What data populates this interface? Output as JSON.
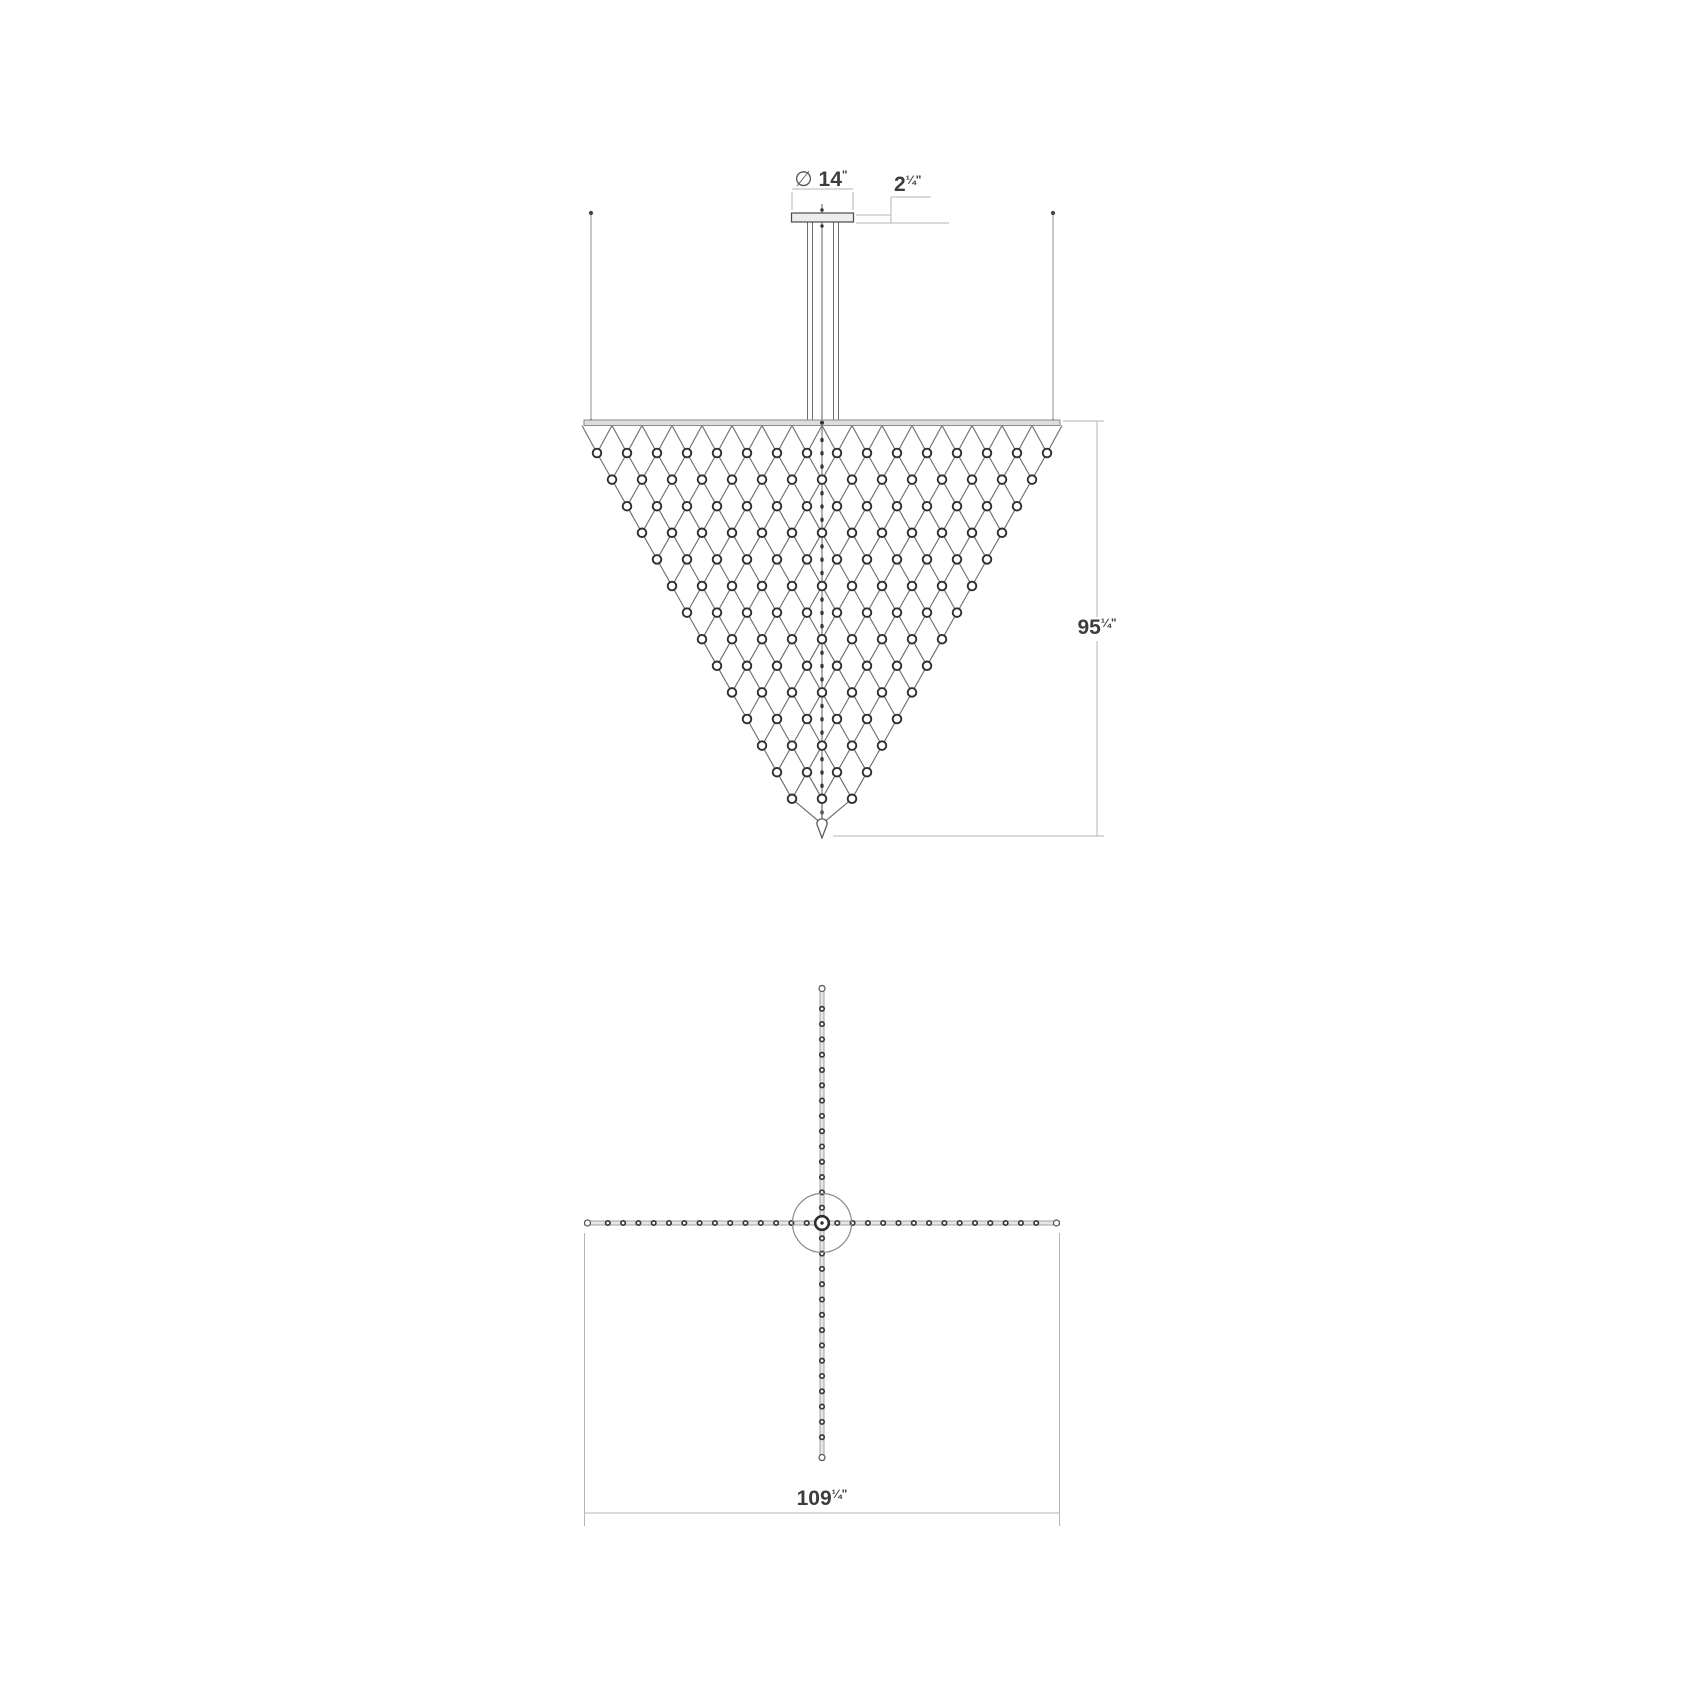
{
  "drawing": {
    "kind": "technical dimension drawing",
    "subject": "inverted pyramid LED net chandelier, elevation and plan views"
  },
  "labels": {
    "canopy_diameter": {
      "prefix": "∅ ",
      "whole": "14",
      "frac": "",
      "unit": "\""
    },
    "canopy_height": {
      "prefix": "",
      "whole": "2",
      "frac": "¼",
      "unit": "\""
    },
    "fixture_height": {
      "prefix": "",
      "whole": "95",
      "frac": "¼",
      "unit": "\""
    },
    "overall_width": {
      "prefix": "",
      "whole": "109",
      "frac": "¼",
      "unit": "\""
    }
  },
  "colors": {
    "background": "#ffffff",
    "net_line": "#6f6f6f",
    "node_stroke": "#2e2e2e",
    "node_fill": "#ffffff",
    "bar_fill": "#dddddd",
    "bar_stroke": "#8a8a8a",
    "plate_fill": "#ededed",
    "plate_stroke": "#4a4a4a",
    "wire": "#9a9a9a",
    "dim_line": "#b5b5b5",
    "text": "#3d3d3d",
    "bead": "#383838",
    "arm_fill": "#e6e6e6",
    "arm_stroke": "#9a9a9a"
  },
  "geometry": {
    "canvas": {
      "w": 1700,
      "h": 1700
    },
    "elevation": {
      "cx": 822,
      "plate": {
        "x": 791.5,
        "y": 213,
        "w": 62,
        "h": 9
      },
      "dim14": {
        "line_y": 189,
        "x1": 792,
        "x2": 853,
        "ext_y1": 192,
        "ext_y2": 210,
        "label_x": 821,
        "label_y": 186
      },
      "dim214": {
        "extA_y": 215,
        "extB_y": 223,
        "ext_x1": 856,
        "extA_x2": 891,
        "extB_x2": 949,
        "vx": 891,
        "v_y1": 197,
        "v_y2": 223,
        "h_y": 197,
        "h_x2": 931,
        "label_x": 894,
        "label_y": 191
      },
      "wires": {
        "lx": 591,
        "rx": 1053,
        "y1": 213,
        "y2": 420
      },
      "rods": {
        "xs": [
          807.5,
          833.5
        ],
        "w": 5,
        "y1": 222,
        "y2": 420
      },
      "stem": {
        "x": 822,
        "y1": 204,
        "y2": 824,
        "dot1_y": 210,
        "dot2_y": 226
      },
      "bar": {
        "x1": 584,
        "x2": 1060,
        "y": 420,
        "h": 5.5
      },
      "net": {
        "rows": 14,
        "y0": 453,
        "row_dy": 26.6,
        "spacing": 30,
        "top_count": 16,
        "node_r": 4.3,
        "bead_dy": 13.3,
        "bead_y0": 440,
        "bead_y1": 814
      },
      "finial": {
        "top_y": 824,
        "tip_y": 838,
        "half_w": 5.2
      },
      "dim95": {
        "vx": 1097,
        "y1": 421,
        "y2": 836,
        "ext_top_x1": 1063,
        "ext_bot_x1": 833,
        "ext_x2": 1104,
        "label_x": 1097,
        "label_y": 634
      }
    },
    "plan": {
      "cx": 822,
      "cy": 1223,
      "half_span": 237.5,
      "arm_th": 4,
      "bead_step": 15.3,
      "bead_count": 14,
      "bead_r": 2.2,
      "tip_r": 3,
      "canopy_r": 29.5,
      "knob_r": 6.8,
      "knob_dot_r": 1.7,
      "dim109": {
        "ext_y1": 1233,
        "ext_y2": 1526,
        "line_y": 1513,
        "label_x": 822,
        "label_y": 1505
      }
    }
  }
}
